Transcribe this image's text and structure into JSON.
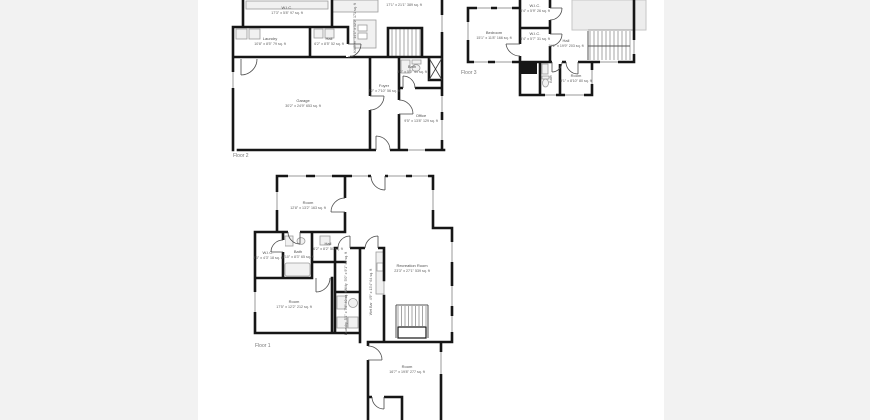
{
  "meta": {
    "page_background": "#f2f2f2",
    "sheet_background": "#ffffff",
    "wall_color": "#161616",
    "label_color": "#5e5e5e",
    "fixture_fill": "#f1f1f1",
    "roof_area_fill": "#ededed"
  },
  "floor2": {
    "label": "Floor 2",
    "rooms": {
      "wic": {
        "name": "W.I.C.",
        "dims": "17'3\" x 5'8\" 97 sq. ft"
      },
      "laundry": {
        "name": "Laundry",
        "dims": "10'8\" x 8'5\" 79 sq. ft"
      },
      "hall": {
        "name": "Hall",
        "dims": "6'2\" x 8'5\" 52 sq. ft"
      },
      "kitchen": {
        "name": "Kitchen",
        "dims": "14'1\" x 12'2\" 171 sq. ft"
      },
      "greatroom": {
        "name": "",
        "dims": "17'1\" x 21'1\" 389 sq. ft"
      },
      "garage": {
        "name": "Garage",
        "dims": "30'2\" x 24'9\" 653 sq. ft"
      },
      "foyer": {
        "name": "Foyer",
        "dims": "7'2\" x 7'10\" 56 sq. ft"
      },
      "bath": {
        "name": "Bath",
        "dims": "8'2\" x 5'0\" 41 sq. ft"
      },
      "office": {
        "name": "Office",
        "dims": "9'5\" x 13'8\" 129 sq. ft"
      }
    }
  },
  "floor3": {
    "label": "Floor 3",
    "rooms": {
      "bedroom": {
        "name": "Bedroom",
        "dims": "15'1\" x 11'8\" 166 sq. ft"
      },
      "wic1": {
        "name": "W.I.C.",
        "dims": "5'4\" x 5'9\" 26 sq. ft"
      },
      "wic2": {
        "name": "W.I.C.",
        "dims": "5'4\" x 5'7\" 31 sq. ft"
      },
      "hall": {
        "name": "Hall",
        "dims": "11'2\" x 19'9\" 203 sq. ft"
      },
      "bath": {
        "name": "Bath",
        "dims": ""
      },
      "room": {
        "name": "Room",
        "dims": "9'1\" x 8'10\" 80 sq. ft"
      }
    }
  },
  "floor1": {
    "label": "Floor 1",
    "rooms": {
      "room_top": {
        "name": "Room",
        "dims": "12'8\" x 13'2\" 163 sq. ft"
      },
      "hall": {
        "name": "Hall",
        "dims": "6'2\" x 8'2\" 50 sq. ft"
      },
      "bath": {
        "name": "Bath",
        "dims": "7'10\" x 8'3\" 65 sq. ft"
      },
      "wic": {
        "name": "W.I.C.",
        "dims": "4'3\" x 4'3\" 18 sq. ft"
      },
      "room_left": {
        "name": "Room",
        "dims": "17'5\" x 12'2\" 212 sq. ft"
      },
      "utility": {
        "name": "Utility",
        "dims": "5'0\" x 9'1\" 46 sq. ft"
      },
      "laundry": {
        "name": "Laundry",
        "dims": "5'1\" x 7'9\" 40 sq. ft"
      },
      "wetbar": {
        "name": "Wet Bar",
        "dims": "4'9\" x 13'4\" 64 sq. ft"
      },
      "rec": {
        "name": "Recreation Room",
        "dims": "23'3\" x 27'1\" 539 sq. ft"
      },
      "room_bottom": {
        "name": "Room",
        "dims": "16'7\" x 19'8\" 277 sq. ft"
      }
    }
  }
}
